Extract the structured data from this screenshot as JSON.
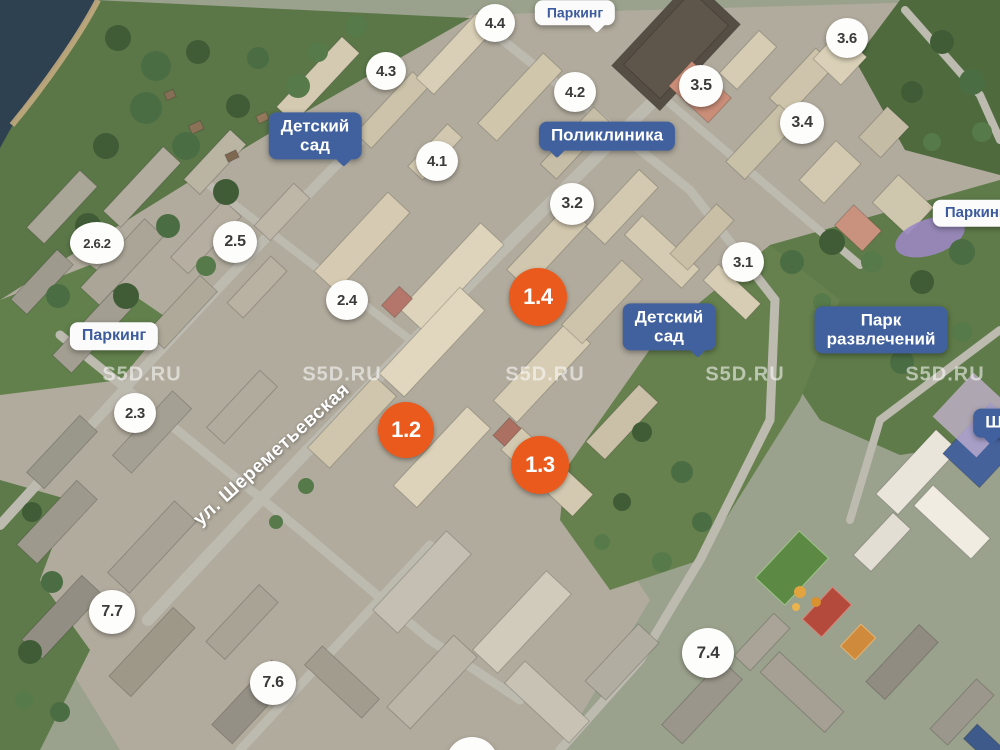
{
  "map": {
    "watermark": {
      "text": "S5D.RU",
      "positions": [
        [
          142,
          375
        ],
        [
          342,
          375
        ],
        [
          545,
          375
        ],
        [
          745,
          375
        ],
        [
          945,
          375
        ]
      ]
    },
    "street_label": {
      "text": "ул. Шереметьевская",
      "x": 272,
      "y": 455,
      "angle": -42
    },
    "building_markers": [
      {
        "type": "white",
        "label": "4.4",
        "x": 495,
        "y": 23,
        "w": 40,
        "h": 38,
        "fs": 15
      },
      {
        "type": "white",
        "label": "4.3",
        "x": 386,
        "y": 71,
        "w": 40,
        "h": 38,
        "fs": 15
      },
      {
        "type": "white",
        "label": "4.2",
        "x": 575,
        "y": 92,
        "w": 42,
        "h": 40,
        "fs": 15
      },
      {
        "type": "white",
        "label": "4.1",
        "x": 437,
        "y": 161,
        "w": 42,
        "h": 40,
        "fs": 15
      },
      {
        "type": "white",
        "label": "3.6",
        "x": 847,
        "y": 38,
        "w": 42,
        "h": 40,
        "fs": 15
      },
      {
        "type": "white",
        "label": "3.5",
        "x": 701,
        "y": 86,
        "w": 44,
        "h": 42,
        "fs": 16
      },
      {
        "type": "white",
        "label": "3.4",
        "x": 802,
        "y": 123,
        "w": 44,
        "h": 42,
        "fs": 16
      },
      {
        "type": "white",
        "label": "3.2",
        "x": 572,
        "y": 204,
        "w": 44,
        "h": 42,
        "fs": 16
      },
      {
        "type": "white",
        "label": "3.1",
        "x": 743,
        "y": 262,
        "w": 42,
        "h": 40,
        "fs": 15
      },
      {
        "type": "white",
        "label": "2.6.2",
        "x": 97,
        "y": 243,
        "w": 54,
        "h": 42,
        "fs": 13
      },
      {
        "type": "white",
        "label": "2.5",
        "x": 235,
        "y": 242,
        "w": 44,
        "h": 42,
        "fs": 16
      },
      {
        "type": "white",
        "label": "2.4",
        "x": 347,
        "y": 300,
        "w": 42,
        "h": 40,
        "fs": 15
      },
      {
        "type": "white",
        "label": "2.3",
        "x": 135,
        "y": 413,
        "w": 42,
        "h": 40,
        "fs": 15
      },
      {
        "type": "white",
        "label": "7.7",
        "x": 112,
        "y": 612,
        "w": 46,
        "h": 44,
        "fs": 16
      },
      {
        "type": "white",
        "label": "7.6",
        "x": 273,
        "y": 683,
        "w": 46,
        "h": 44,
        "fs": 16
      },
      {
        "type": "white",
        "label": "7.4",
        "x": 708,
        "y": 653,
        "w": 52,
        "h": 50,
        "fs": 17
      },
      {
        "type": "white",
        "label": "",
        "x": 472,
        "y": 762,
        "w": 52,
        "h": 50,
        "fs": 15
      },
      {
        "type": "orange",
        "label": "1.4",
        "x": 538,
        "y": 297,
        "w": 58,
        "h": 58,
        "fs": 22
      },
      {
        "type": "orange",
        "label": "1.2",
        "x": 406,
        "y": 430,
        "w": 56,
        "h": 56,
        "fs": 22
      },
      {
        "type": "orange",
        "label": "1.3",
        "x": 540,
        "y": 465,
        "w": 58,
        "h": 58,
        "fs": 22
      }
    ],
    "amenity_badges": [
      {
        "name": "kindergarten-badge-west",
        "label": "Детский\nсад",
        "x": 315,
        "y": 136,
        "fs": 17,
        "style": "blue",
        "tail": "br"
      },
      {
        "name": "polyclinic-badge",
        "label": "Поликлиника",
        "x": 607,
        "y": 136,
        "fs": 17,
        "style": "blue",
        "tail": "bl"
      },
      {
        "name": "kindergarten-badge-east",
        "label": "Детский\nсад",
        "x": 669,
        "y": 327,
        "fs": 17,
        "style": "blue",
        "tail": "br"
      },
      {
        "name": "amusement-park-badge",
        "label": "Парк\nразвлечений",
        "x": 881,
        "y": 330,
        "fs": 17,
        "style": "blue",
        "tail": ""
      },
      {
        "name": "school-badge",
        "label": "Школа",
        "x": 1013,
        "y": 423,
        "fs": 17,
        "style": "blue",
        "tail": "bl"
      },
      {
        "name": "parking-badge-north",
        "label": "Паркинг",
        "x": 575,
        "y": 13,
        "fs": 14,
        "style": "white",
        "tail": "br"
      },
      {
        "name": "parking-badge-west",
        "label": "Паркинг",
        "x": 114,
        "y": 336,
        "fs": 16,
        "style": "white",
        "tail": ""
      },
      {
        "name": "parking-badge-east",
        "label": "Паркинг",
        "x": 975,
        "y": 213,
        "fs": 15,
        "style": "white",
        "tail": ""
      }
    ],
    "colors": {
      "badge_blue": "#41619e",
      "badge_white_bg": "#fbfbfc",
      "badge_white_text": "#3c5c9e",
      "marker_white_bg": "#fdfdfc",
      "marker_white_text": "#3b3b3b",
      "marker_orange": "#eb5a1d",
      "watermark": "rgba(255,255,255,0.55)",
      "street_text": "#ffffff"
    }
  }
}
